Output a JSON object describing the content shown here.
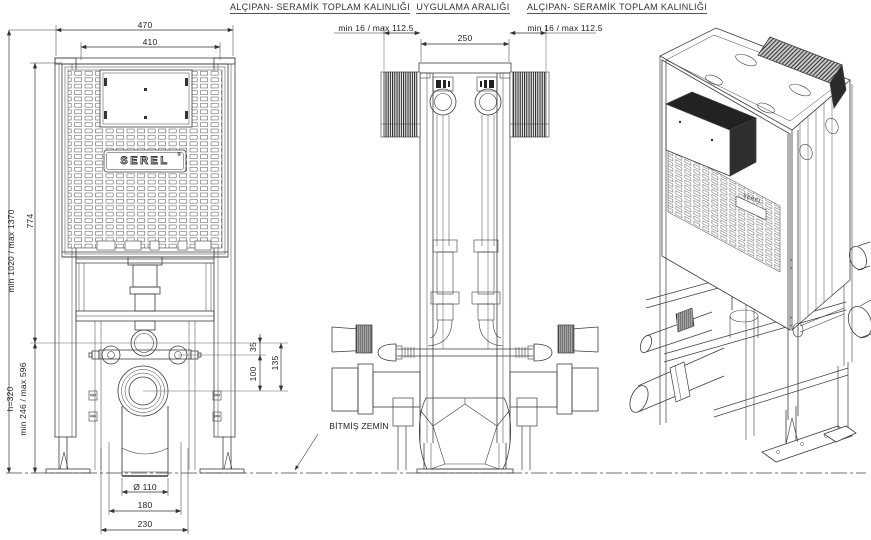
{
  "drawing": {
    "labels": {
      "wall_total_left": "ALÇIPAN- SERAMİK TOPLAM KALINLIĞI",
      "application_gap": "UYGULAMA ARALIĞI",
      "wall_total_right": "ALÇIPAN- SERAMİK TOPLAM KALINLIĞI",
      "finished_floor": "BİTMİŞ ZEMİN"
    },
    "brand": {
      "logo": "SEREL",
      "logo_iso": "SEREL",
      "reg_mark": "®"
    },
    "front_view": {
      "width_outer": "470",
      "width_inner": "410",
      "height_range": "min 1020 / max 1370",
      "tank_height": "774",
      "outlet_height": "h=320",
      "outlet_range": "min 246 / max 596",
      "offset_flush_to_bolts": "35",
      "offset_flush_to_drain": "135",
      "offset_bolts_to_drain": "100",
      "drain_diameter": "Ø 110",
      "drain_span_inner": "180",
      "drain_span_outer": "230"
    },
    "side_view": {
      "wall_left": "min 16 / max 112.5",
      "frame_depth": "250",
      "wall_right": "min 16 / max 112.5"
    }
  }
}
